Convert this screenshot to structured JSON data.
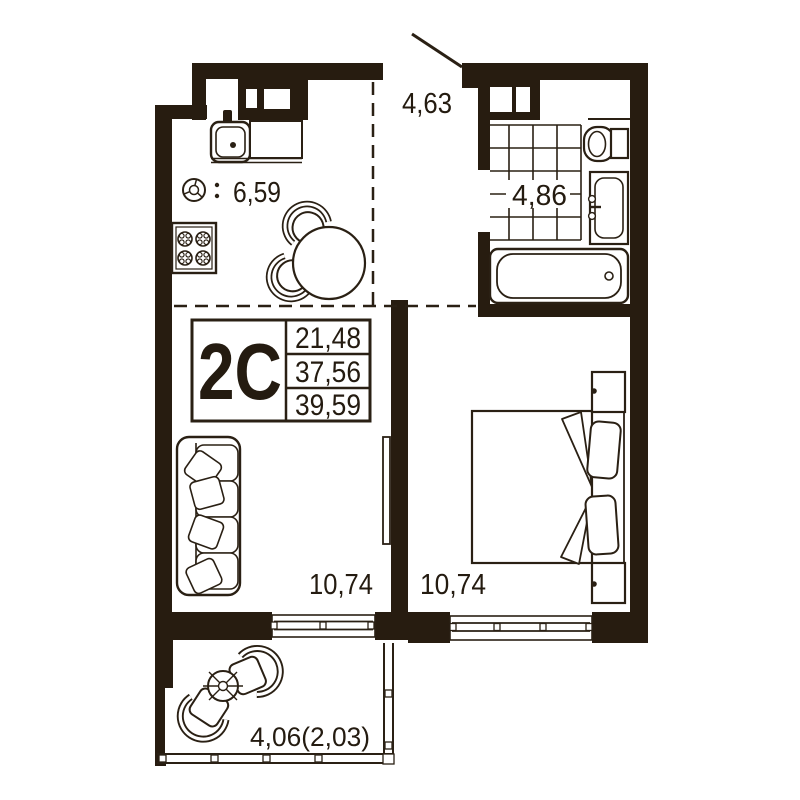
{
  "unit": {
    "type_label": "2C",
    "area_rows": [
      "21,48",
      "37,56",
      "39,59"
    ]
  },
  "rooms": {
    "kitchen": {
      "area": "6,59"
    },
    "hallway": {
      "area": "4,63"
    },
    "bathroom": {
      "area": "4,86"
    },
    "living_room": {
      "area": "10,74"
    },
    "bedroom": {
      "area": "10,74"
    },
    "balcony": {
      "area": "4,06(2,03)"
    }
  },
  "colors": {
    "wall": "#271c10",
    "line": "#2a2014",
    "text": "#241b10",
    "background": "#ffffff"
  }
}
